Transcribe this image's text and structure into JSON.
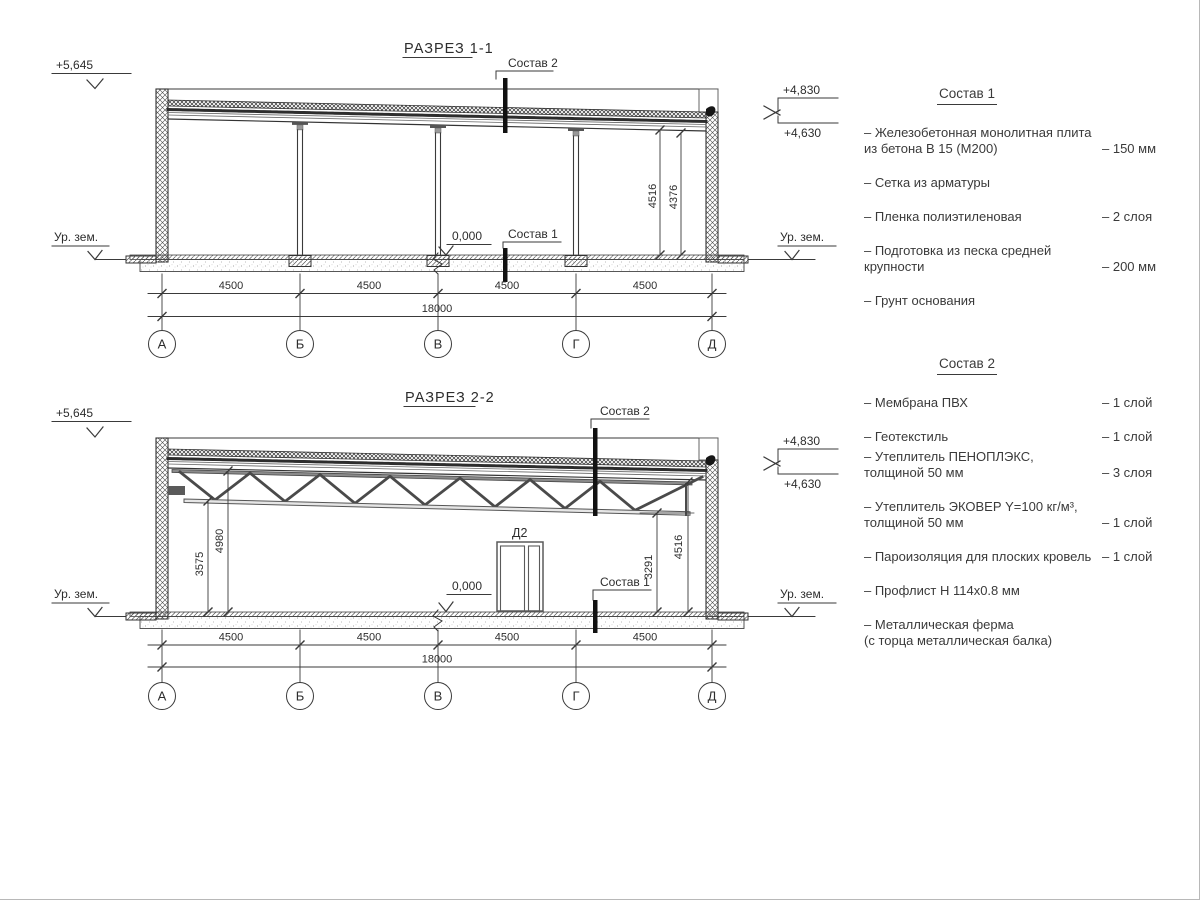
{
  "colors": {
    "line": "#3a3a3a",
    "dark": "#161616",
    "bg": "#ffffff"
  },
  "section1": {
    "title": "РАЗРЕЗ 1-1",
    "labels": {
      "sostav2": "Состав 2",
      "sostav1": "Состав 1",
      "zero": "0,000"
    },
    "levels": {
      "left": "+5,645",
      "right_top": "+4,830",
      "right_bottom": "+4,630",
      "ground_left": "Ур. зем.",
      "ground_right": "Ур. зем."
    },
    "dims": {
      "v1": "4516",
      "v2": "4376",
      "bays": [
        "4500",
        "4500",
        "4500",
        "4500"
      ],
      "total": "18000"
    },
    "axes": [
      "А",
      "Б",
      "В",
      "Г",
      "Д"
    ]
  },
  "section2": {
    "title": "РАЗРЕЗ 2-2",
    "labels": {
      "sostav2": "Состав 2",
      "sostav1": "Состав 1",
      "zero": "0,000",
      "door": "Д2"
    },
    "levels": {
      "left": "+5,645",
      "right_top": "+4,830",
      "right_bottom": "+4,630",
      "ground_left": "Ур. зем.",
      "ground_right": "Ур. зем."
    },
    "dims": {
      "v1": "3575",
      "v2": "4980",
      "v3": "3291",
      "v4": "4516",
      "bays": [
        "4500",
        "4500",
        "4500",
        "4500"
      ],
      "total": "18000"
    },
    "axes": [
      "А",
      "Б",
      "В",
      "Г",
      "Д"
    ]
  },
  "spec1": {
    "title": "Состав 1",
    "items": [
      {
        "name": "– Железобетонная  монолитная плита\nиз бетона В 15 (М200)",
        "value": "– 150 мм"
      },
      {
        "name": "– Сетка из арматуры",
        "value": ""
      },
      {
        "name": "– Пленка полиэтиленовая",
        "value": "–  2 слоя"
      },
      {
        "name": "– Подготовка из песка средней\nкрупности",
        "value": "– 200 мм"
      },
      {
        "name": "– Грунт основания",
        "value": ""
      }
    ]
  },
  "spec2": {
    "title": "Состав 2",
    "items": [
      {
        "name": "– Мембрана ПВХ",
        "value": "– 1 слой"
      },
      {
        "name": "– Геотекстиль",
        "value": "– 1 слой"
      },
      {
        "name": "– Утеплитель ПЕНОПЛЭКС,\nтолщиной 50 мм",
        "value": "– 3 слоя"
      },
      {
        "name": "– Утеплитель ЭКОВЕР Y=100 кг/м³,\nтолщиной 50 мм",
        "value": "– 1 слой"
      },
      {
        "name": "– Пароизоляция для плоских кровель",
        "value": "– 1 слой"
      },
      {
        "name": "– Профлист Н 114х0.8 мм",
        "value": ""
      },
      {
        "name": "– Металлическая ферма\n(с торца металлическая балка)",
        "value": ""
      }
    ]
  }
}
